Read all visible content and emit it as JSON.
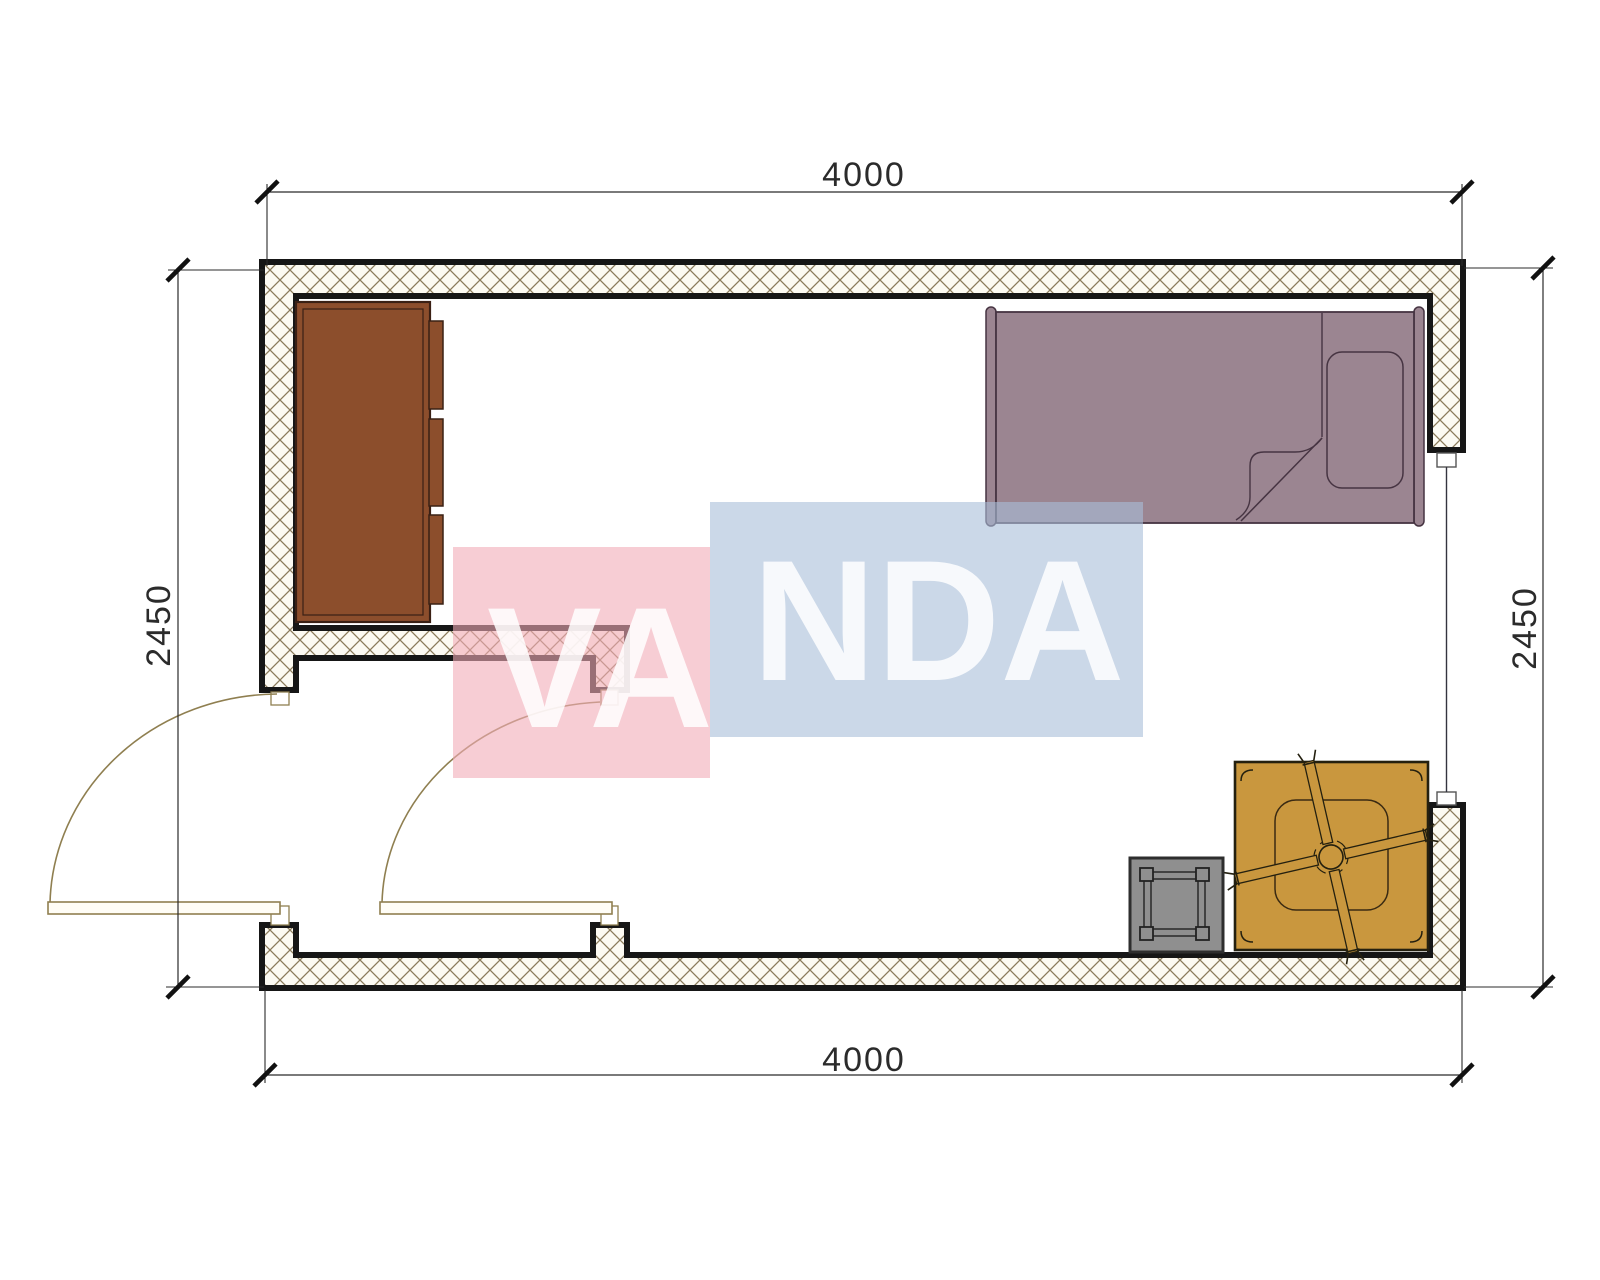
{
  "plan": {
    "title": "room-floor-plan",
    "dimensions": {
      "top": "4000",
      "bottom": "4000",
      "left": "2450",
      "right": "2450"
    },
    "watermark": {
      "full_text": "VANDA",
      "part1": "VA",
      "part2": "NDA"
    },
    "furniture": {
      "wardrobe": "wardrobe",
      "bed": "single-bed",
      "pillow": "pillow",
      "fan_table": "table-with-ceiling-fan",
      "stool": "stool",
      "door_left": "left-swing-door",
      "door_inner": "inner-swing-door",
      "window": "window"
    },
    "colors": {
      "wall_fill": "#fcfaf2",
      "wall_hatch_line": "#8b7b5b",
      "wall_outline": "#161616",
      "cabinet": "#8c4e2c",
      "cabinet_outline": "#3a2014",
      "bed": "#9b8591",
      "bed_outline": "#463442",
      "table": "#c9973e",
      "table_outline": "#24200f",
      "stool": "#8f8f8f",
      "stool_outline": "#2e2e2e",
      "door_line": "#8f7f50",
      "door_leaf_fill": "#fffdf6",
      "jamb_fill": "#ffffff",
      "window_line": "#34343f",
      "dim_line": "#2b2b2b",
      "watermark_pink": "rgba(242,172,183,0.60)",
      "watermark_blue": "rgba(168,190,217,0.60)",
      "watermark_text": "rgba(255,255,255,0.85)"
    }
  }
}
